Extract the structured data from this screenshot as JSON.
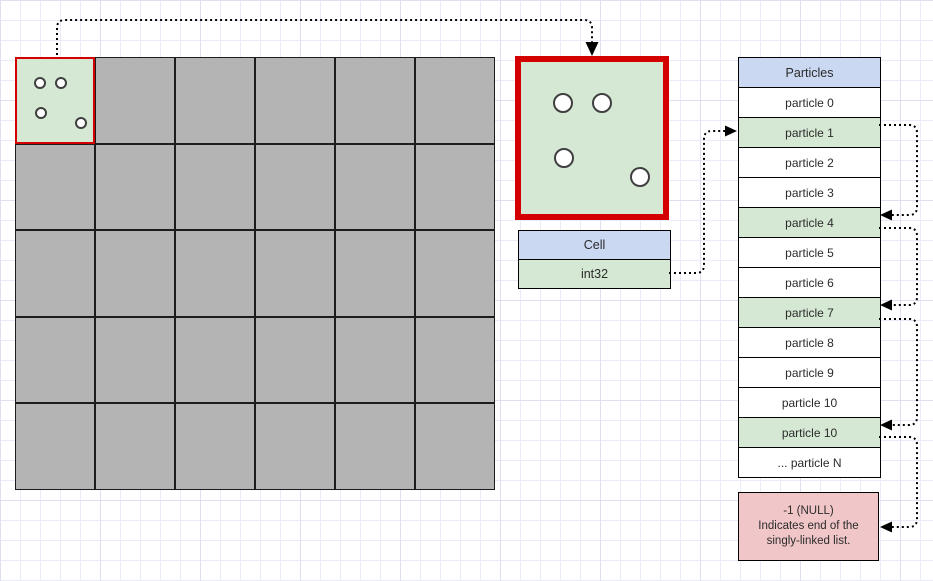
{
  "diagram": {
    "grid": {
      "columns": 6,
      "rows": 5,
      "cell_fill": "#b4b4b4",
      "highlight": {
        "row": 0,
        "col": 0,
        "fill": "#d5e8d4",
        "border": "#d40000",
        "particles": [
          {
            "x": 23,
            "y": 24
          },
          {
            "x": 44,
            "y": 24
          },
          {
            "x": 24,
            "y": 54
          },
          {
            "x": 64,
            "y": 64
          }
        ]
      }
    },
    "zoom_cell": {
      "fill": "#d5e8d4",
      "border": "#d40000",
      "particles": [
        {
          "x": 42,
          "y": 41
        },
        {
          "x": 81,
          "y": 41
        },
        {
          "x": 43,
          "y": 96
        },
        {
          "x": 119,
          "y": 115
        }
      ]
    },
    "cell_struct": {
      "title": "Cell",
      "field": "int32",
      "title_fill": "#cad8f2",
      "field_fill": "#d5e8d4"
    },
    "particles_table": {
      "title": "Particles",
      "title_fill": "#cad8f2",
      "row_fill": "#ffffff",
      "highlight_fill": "#d5e8d4",
      "rows": [
        {
          "label": "particle 0",
          "highlighted": false
        },
        {
          "label": "particle 1",
          "highlighted": true
        },
        {
          "label": "particle 2",
          "highlighted": false
        },
        {
          "label": "particle 3",
          "highlighted": false
        },
        {
          "label": "particle 4",
          "highlighted": true
        },
        {
          "label": "particle 5",
          "highlighted": false
        },
        {
          "label": "particle 6",
          "highlighted": false
        },
        {
          "label": "particle 7",
          "highlighted": true
        },
        {
          "label": "particle 8",
          "highlighted": false
        },
        {
          "label": "particle 9",
          "highlighted": false
        },
        {
          "label": "particle 10",
          "highlighted": false
        },
        {
          "label": "particle 10",
          "highlighted": true
        },
        {
          "label": "... particle N",
          "highlighted": false
        }
      ]
    },
    "null_box": {
      "fill": "#f1c6c8",
      "lines": [
        "-1 (NULL)",
        "Indicates end of the",
        "singly-linked list."
      ]
    },
    "connectors": [
      {
        "name": "grid-cell-to-zoom-cell"
      },
      {
        "name": "int32-to-particle-1"
      },
      {
        "name": "particle-1-to-particle-4"
      },
      {
        "name": "particle-4-to-particle-7"
      },
      {
        "name": "particle-7-to-particle-10"
      },
      {
        "name": "particle-10-to-null"
      }
    ],
    "link_color": "#000000"
  }
}
